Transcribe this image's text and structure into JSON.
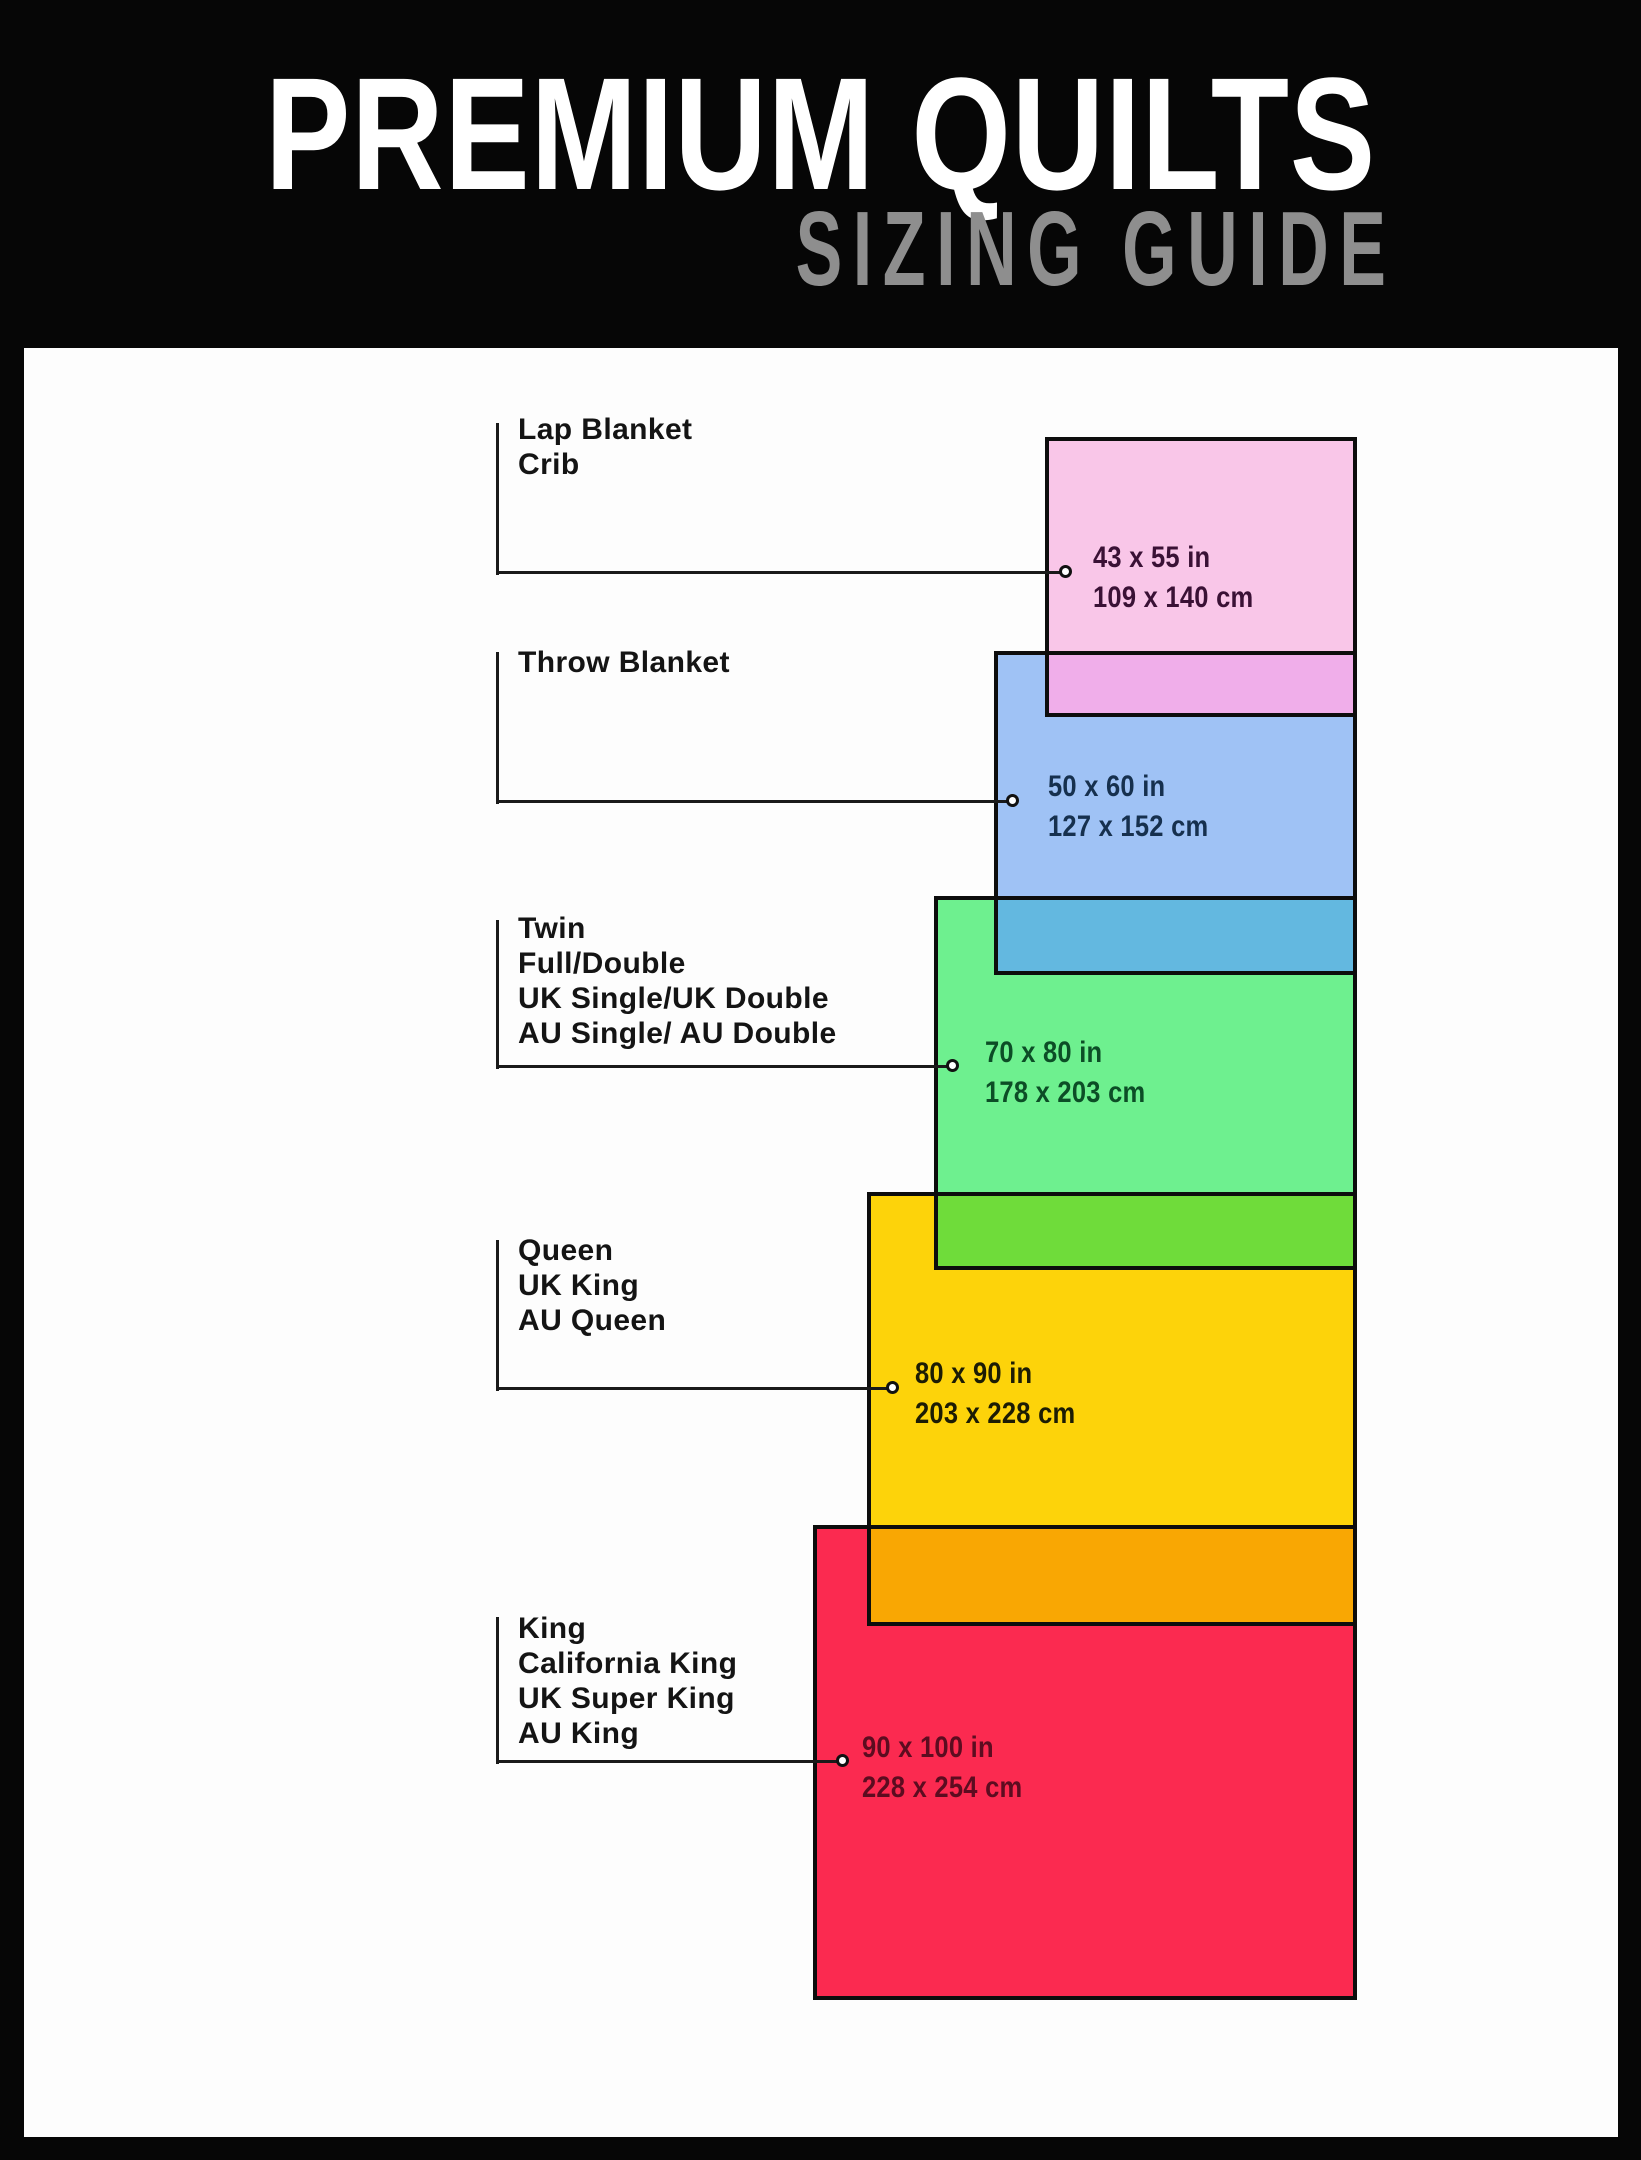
{
  "header": {
    "title": "PREMIUM QUILTS",
    "subtitle": "SIZING GUIDE",
    "title_color": "#ffffff",
    "subtitle_color": "#8e8e8e"
  },
  "page_background": "#060606",
  "board_background": "#fdfdfd",
  "line_color": "#1a1a1a",
  "border_color": "#0d0d0d",
  "items": [
    {
      "names": [
        "Lap Blanket",
        "Crib"
      ],
      "size_in": "43 x 55 in",
      "size_cm": "109 x 140 cm",
      "fill": "#f9c6e8",
      "text_color": "#3a1135"
    },
    {
      "names": [
        "Throw Blanket"
      ],
      "size_in": "50 x 60 in",
      "size_cm": "127 x 152 cm",
      "fill": "#9fc2f5",
      "text_color": "#16304e"
    },
    {
      "names": [
        "Twin",
        "Full/Double",
        "UK Single/UK Double",
        "AU Single/ AU Double"
      ],
      "size_in": "70 x 80 in",
      "size_cm": "178 x 203 cm",
      "fill": "#6ef08f",
      "text_color": "#0c4d26"
    },
    {
      "names": [
        "Queen",
        "UK King",
        "AU Queen"
      ],
      "size_in": "80 x 90 in",
      "size_cm": "203 x 228 cm",
      "fill": "#fdd30a",
      "text_color": "#1c1c04"
    },
    {
      "names": [
        "King",
        "California King",
        "UK Super King",
        "AU King"
      ],
      "size_in": "90 x 100 in",
      "size_cm": "228 x 254 cm",
      "fill": "#fb2a50",
      "text_color": "#5c0c20"
    }
  ],
  "overlaps": [
    {
      "name": "lap-over-throw",
      "fill": "#f0aeea"
    },
    {
      "name": "throw-over-twin",
      "fill": "#63b8e0"
    },
    {
      "name": "twin-over-queen",
      "fill": "#6fdc3a"
    },
    {
      "name": "queen-over-king",
      "fill": "#f9a703"
    }
  ]
}
